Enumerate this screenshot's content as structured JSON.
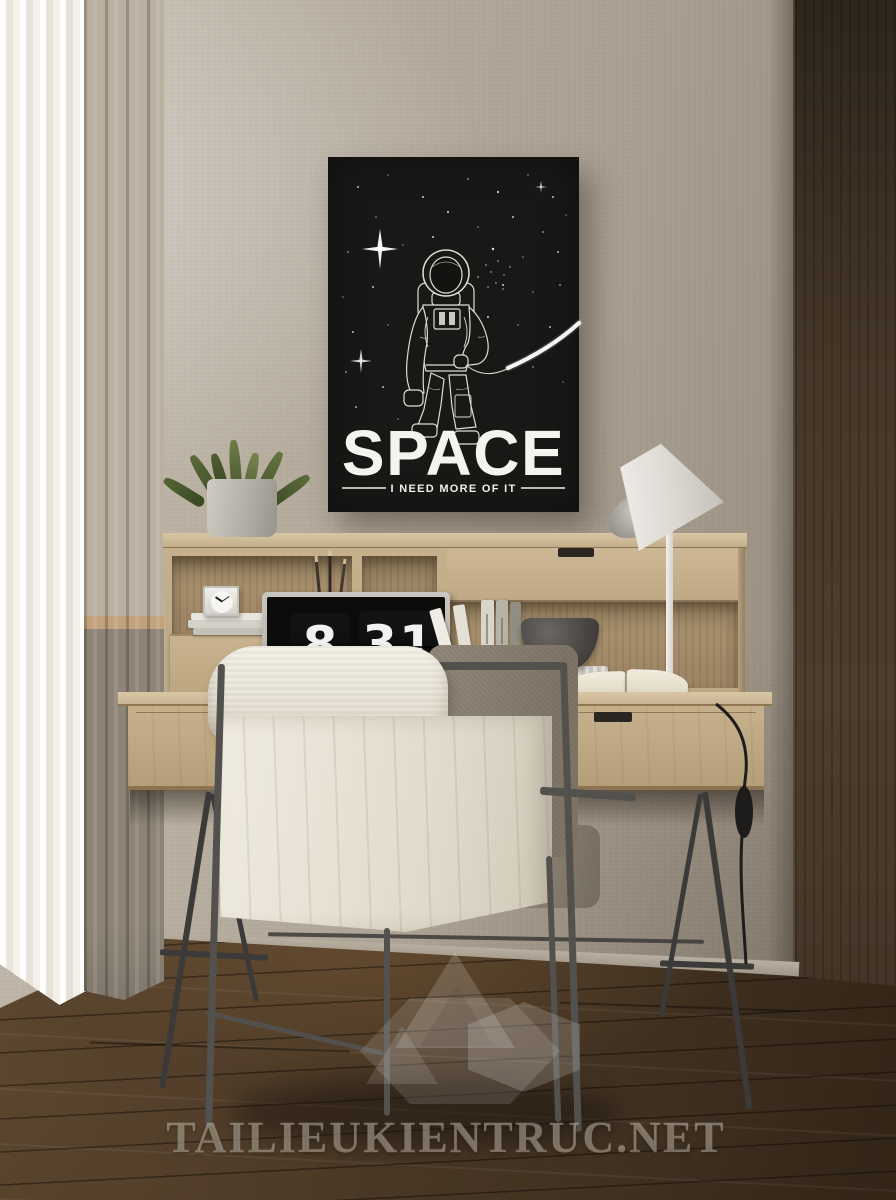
{
  "scene": {
    "setting": "home office interior render",
    "wall_color": "#b3aa9c",
    "floor_color": "#4a3826",
    "desk_wood_color": "#c8b290",
    "dark_panel_color": "#3f342a"
  },
  "poster": {
    "title": "SPACE",
    "subtitle": "I NEED MORE OF IT",
    "background": "#181816",
    "foreground": "#f2f1ed",
    "artwork": "astronaut line drawing with stars and planet horizon arc"
  },
  "laptop_clock": {
    "hour": "8",
    "minute": "31",
    "weekday": "FRI"
  },
  "watermark": {
    "text": "TAILIEUKIENTRUC.NET",
    "logo": "translucent geometric cubes"
  },
  "objects": [
    "succulent plant in concrete pot",
    "square desk clock on book stack",
    "laptop showing flip-clock",
    "pencils behind laptop",
    "standing books",
    "stone bowl on ridged white box",
    "open book",
    "white desk lamp with cable switch",
    "metal-frame chair with cream throw blanket",
    "two-tone curtains",
    "dark wood wardrobe panel"
  ]
}
